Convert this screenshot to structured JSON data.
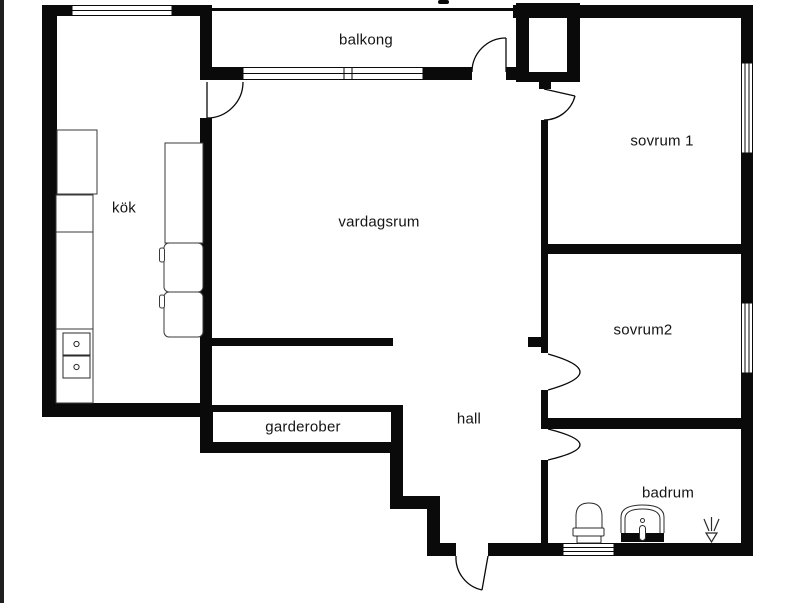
{
  "floorplan": {
    "background_color": "#ffffff",
    "wall_color": "#0a0a0a",
    "rooms": [
      {
        "name": "balkong",
        "label": "balkong"
      },
      {
        "name": "kok",
        "label": "kök"
      },
      {
        "name": "vardagsrum",
        "label": "vardagsrum"
      },
      {
        "name": "sovrum-1",
        "label": "sovrum 1"
      },
      {
        "name": "sovrum-2",
        "label": "sovrum2"
      },
      {
        "name": "hall",
        "label": "hall"
      },
      {
        "name": "garderober",
        "label": "garderober"
      },
      {
        "name": "badrum",
        "label": "badrum"
      }
    ],
    "fixtures": [
      "toilet-icon",
      "sink-icon",
      "shower-drain-icon",
      "stove-burners-icon",
      "kitchen-counter",
      "kitchen-island",
      "balcony-railing"
    ]
  }
}
